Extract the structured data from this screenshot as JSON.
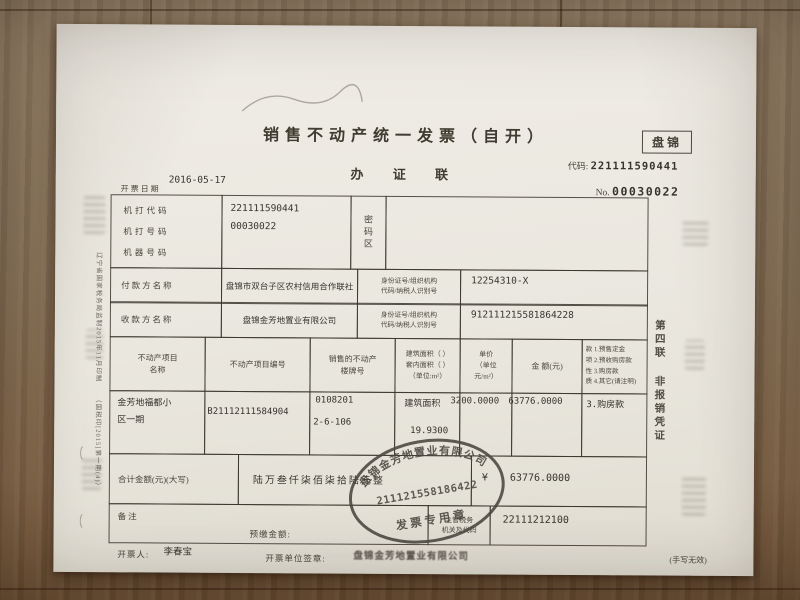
{
  "header": {
    "title": "销售不动产统一发票（自开）",
    "copy_name": "办 证 联",
    "region": "盘锦",
    "code_label": "代码:",
    "code_value": "221111590441",
    "no_label": "No.",
    "no_value": "00030022",
    "date_label": "开票日期",
    "date_value": "2016-05-17"
  },
  "machine_info": {
    "rows": [
      {
        "label": "机打代码",
        "value": "221111590441"
      },
      {
        "label": "机打号码",
        "value": "00030022"
      },
      {
        "label": "机器号码",
        "value": ""
      }
    ],
    "password_area_label": "密码区"
  },
  "parties": {
    "payer": {
      "label": "付款方名称",
      "name": "盘锦市双台子区农村信用合作联社",
      "id_label_line1": "身份证号/组织机构",
      "id_label_line2": "代码/纳税人识别号",
      "id_value": "12254310-X"
    },
    "payee": {
      "label": "收款方名称",
      "name": "盘锦金芳地置业有限公司",
      "id_label_line1": "身份证号/组织机构",
      "id_label_line2": "代码/纳税人识别号",
      "id_value": "912111215581864228"
    }
  },
  "items_table": {
    "headers": {
      "project_name_l1": "不动产项目",
      "project_name_l2": "名称",
      "project_number": "不动产项目编号",
      "building_no_l1": "销售的不动产",
      "building_no_l2": "楼牌号",
      "area_l1": "建筑面积（ ）",
      "area_l2": "套内面积（ ）",
      "area_l3": "（单位:m²）",
      "unit_price_l1": "单价",
      "unit_price_l2": "（单位",
      "unit_price_l3": "元/m²）",
      "amount": "金 额(元)",
      "payment_nature_chars": [
        "款",
        "项",
        "性",
        "质"
      ],
      "payment_options": [
        "1.预售定金",
        "2.预收购房款",
        "3.购房款",
        "4.其它(请注明)"
      ]
    },
    "row": {
      "project_name_l1": "金芳地福都小",
      "project_name_l2": "区一期",
      "project_number": "B21112111584904",
      "building_no_l1": "0108201",
      "building_no_l2": "2-6-106",
      "area_type": "建筑面积",
      "area_value": "19.9300",
      "unit_price": "3200.0000",
      "amount": "63776.0000",
      "payment_nature": "3.购房款"
    }
  },
  "total_row": {
    "label": "合计金额(元)(大写)",
    "amount_words": "陆万叁仟柒佰柒拾陆元整",
    "currency": "¥",
    "amount": "63776.0000"
  },
  "remarks_row": {
    "remarks_label": "备注",
    "prepaid_label": "预缴金额:",
    "authority_label_l1": "主管税务",
    "authority_label_l2": "机关及代码",
    "authority_code": "22111212100"
  },
  "footer": {
    "issuer_label": "开票人:",
    "issuer": "李春宝",
    "unit_seal_label": "开票单位签章:",
    "unit_seal": "盘锦金芳地置业有限公司",
    "note": "(手写无效)"
  },
  "stamp": {
    "company": "盘锦金芳地置业有限公司",
    "number": "211121558186422",
    "caption": "发票专用章"
  },
  "margins": {
    "left_vertical_1": "辽宁省国家税务局监制2015年11月印制",
    "left_vertical_2": "（国税印[2015]第一期(4)）",
    "right_vertical_l1": "第四联",
    "right_vertical_l2": "非报销凭证"
  },
  "colors": {
    "ink": "#45413a",
    "stamp_ink": "#4b463f",
    "paper": "#ece9e1",
    "wood": "#8a6c4f"
  }
}
